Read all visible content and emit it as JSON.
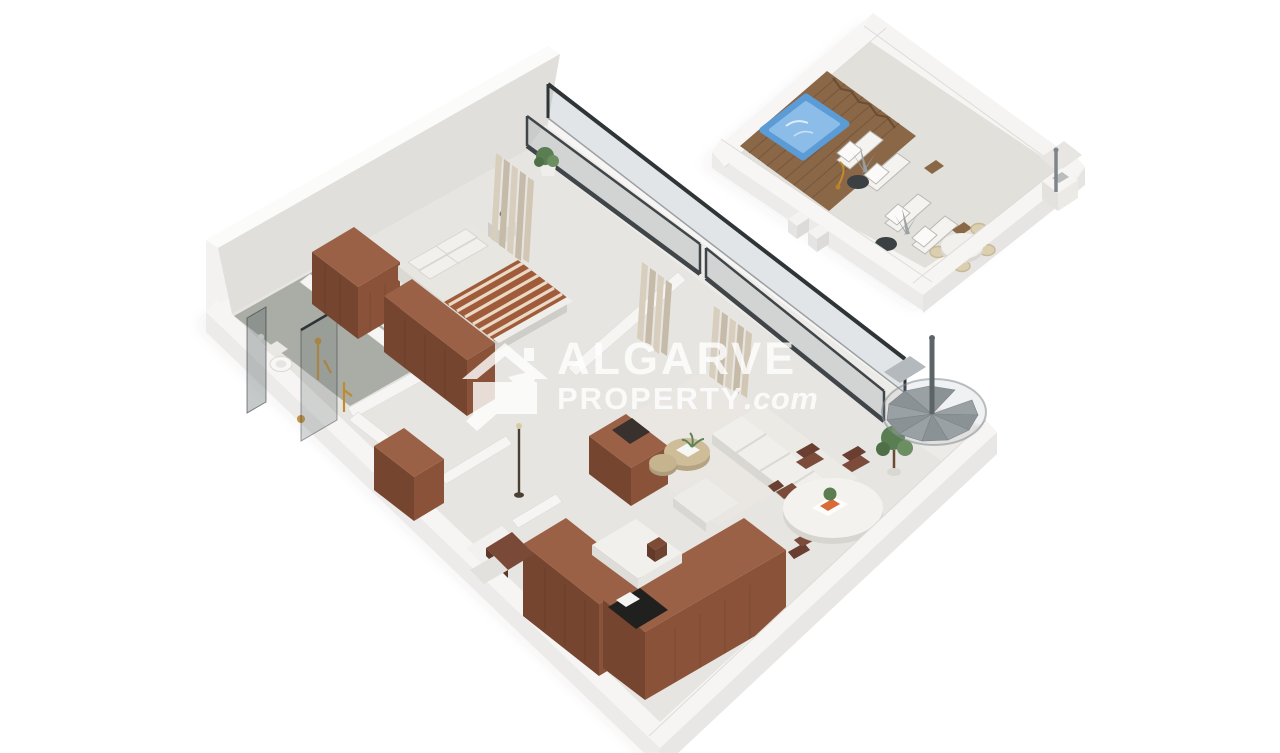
{
  "watermark": {
    "line1": "ALGARVE",
    "line2": "PROPERTY",
    "suffix": ".com",
    "icon": "house-arrow-logo-icon"
  },
  "palette": {
    "background": "#ffffff",
    "slab": "#f6f5f3",
    "wall_face": "#f2f1ef",
    "interior_floor": "#e7e5e1",
    "balcony_floor": "#edebe7",
    "bathroom_floor": "#a4a8a0",
    "terrace_floor": "#e2e0db",
    "wood": "#8a5339",
    "wood_dark": "#76452f",
    "wood_top": "#9a6146",
    "deck": "#8a6747",
    "pool_water": "#5b9bd6",
    "pool_water_light": "#8cbde8",
    "glass_frame": "#3a4043",
    "glass_fill": "rgba(150,160,164,0.30)",
    "curtain": "#cfc5b2",
    "sofa": "#efeeea",
    "stair": "#9aa1a5",
    "gold": "#c08a2e",
    "plant": "#5a7d52",
    "watermark": "rgba(255,255,255,0.80)"
  },
  "scene": {
    "description": "Isometric 3D floor plan of a one-bedroom apartment with private roof terrace",
    "units": [
      {
        "name": "main floor",
        "rooms": [
          "bedroom",
          "bathroom",
          "hallway",
          "kitchen",
          "living room",
          "dining area",
          "balcony"
        ]
      },
      {
        "name": "roof terrace",
        "features": [
          "plunge pool",
          "timber deck",
          "sun loungers",
          "side tables",
          "outdoor dining set",
          "spiral staircase access"
        ]
      }
    ]
  }
}
